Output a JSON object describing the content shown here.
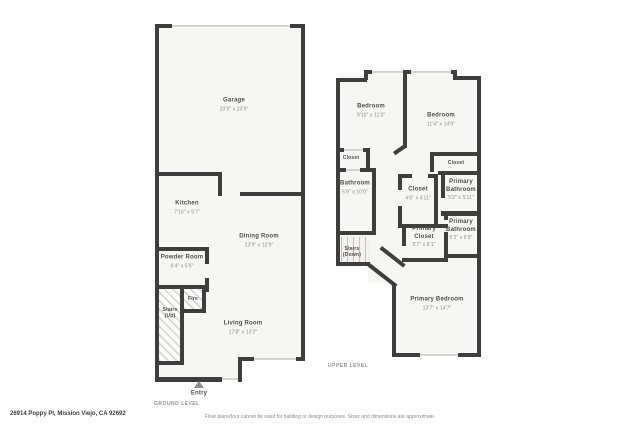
{
  "palette": {
    "wall": "#3e3e3e",
    "floor": "#f6f6f5",
    "room_name_text": "#4e4e4e",
    "dims_text": "#8b8b8b"
  },
  "footer": {
    "address": "26914 Poppy Pl, Mission Viejo, CA 92692",
    "disclaimer": "Floor plans/tour cannot be used for building or design purposes. Sizes and dimensions are approximate."
  },
  "ground": {
    "level_label": "GROUND LEVEL",
    "entry_label": "Entry",
    "stairs": {
      "line1": "Stairs",
      "line2": "(Up)"
    },
    "fire_label": "Fire",
    "rooms": {
      "garage": {
        "name": "Garage",
        "dims": "20'5\" x 23'9\""
      },
      "kitchen": {
        "name": "Kitchen",
        "dims": "7'10\" x 9'7\""
      },
      "dining": {
        "name": "Dining Room",
        "dims": "13'9\" x 12'9\""
      },
      "powder": {
        "name": "Powder Room",
        "dims": "6'4\" x 5'6\""
      },
      "living": {
        "name": "Living Room",
        "dims": "17'8\" x 13'2\""
      }
    }
  },
  "upper": {
    "level_label": "UPPER LEVEL",
    "stairs": {
      "line1": "Stairs",
      "line2": "(Down)"
    },
    "rooms": {
      "bedroom_left": {
        "name": "Bedroom",
        "dims": "9'10\" x 11'3\""
      },
      "bedroom_right": {
        "name": "Bedroom",
        "dims": "11'4\" x 14'9\""
      },
      "closet_left": {
        "name": "Closet"
      },
      "closet_right": {
        "name": "Closet"
      },
      "closet_middle": {
        "name": "Closet",
        "dims": "4'6\" x 4'11\""
      },
      "bathroom": {
        "name": "Bathroom",
        "dims": "5'9\" x 10'0\""
      },
      "primary_bathroom_top": {
        "name": "Primary Bathroom",
        "dims": "5'2\" x 5'11\""
      },
      "primary_closet": {
        "name": "Primary Closet",
        "dims": "5'7\" x 6'1\""
      },
      "primary_bathroom_bottom": {
        "name": "Primary Bathroom",
        "dims": "5'2\" x 6'9\""
      },
      "primary_bedroom": {
        "name": "Primary Bedroom",
        "dims": "13'7\" x 14'7\""
      }
    }
  }
}
